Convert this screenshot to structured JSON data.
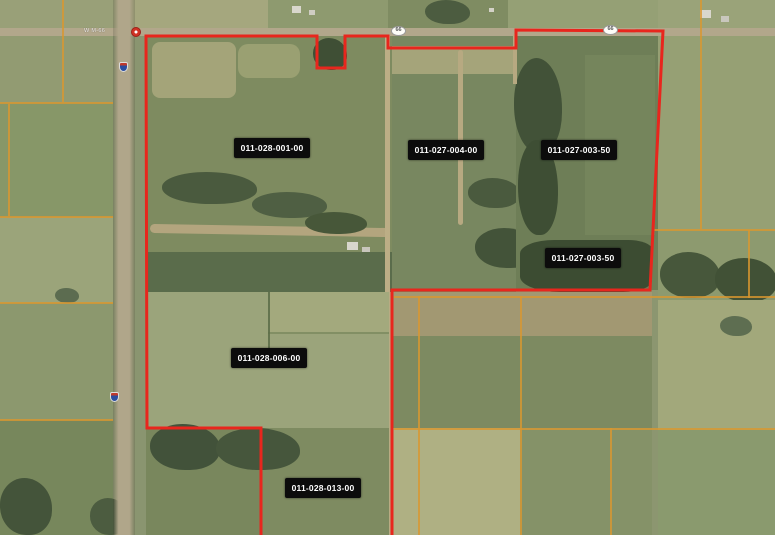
{
  "map": {
    "parcel_labels": [
      "011-028-001-00",
      "011-027-004-00",
      "011-027-003-50",
      "011-027-003-50",
      "011-028-006-00",
      "011-028-013-00"
    ],
    "route_shields": {
      "oval_label": "66",
      "road_label": "W M-66"
    },
    "colors": {
      "boundary_red": "#e8261d",
      "grid_orange": "#d9972f",
      "label_bg": "#0c0c0c",
      "label_text": "#ffffff"
    },
    "icons": {
      "interstate_shield": "interstate-shield-icon",
      "state_route_oval": "route-oval-icon",
      "route_circle": "route-circle-marker-icon"
    }
  }
}
